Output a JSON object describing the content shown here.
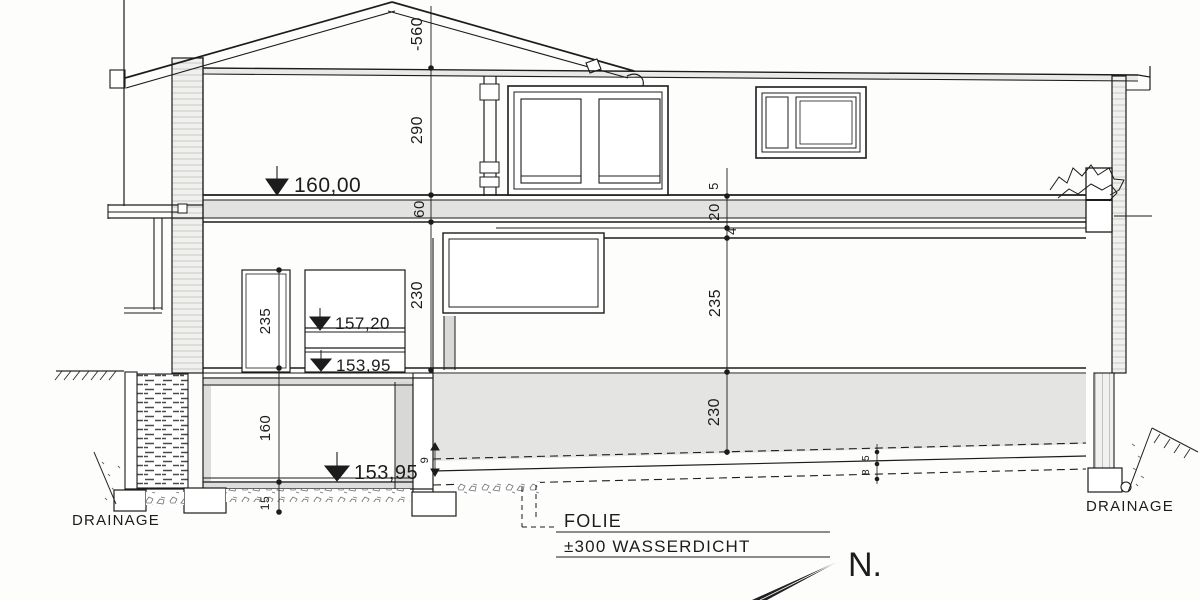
{
  "section": {
    "levels": {
      "eg": "160,00",
      "landing": "157,20",
      "split_lower": "153,95",
      "basement": "153,95"
    },
    "dimensions": {
      "ridge": "-560",
      "upper_room": "290",
      "floor_slab": "60",
      "left_mid_room": "230",
      "door_opening": "235",
      "right_upper_room": "235",
      "right_lower_room": "230",
      "layer_top": "5",
      "layer_mid": "20",
      "layer_bottom": "4",
      "basement_room": "160",
      "basement_slab": "15",
      "slope_left": "9",
      "slope_right_top": "5",
      "slope_right_bottom": "8"
    },
    "notes": {
      "drainage_left": "DRAINAGE",
      "drainage_right": "DRAINAGE",
      "folie_title": "FOLIE",
      "folie_spec": "±300 WASSERDICHT"
    },
    "compass": {
      "north": "N."
    },
    "colors": {
      "line": "#1c1c1c",
      "slab_gray": "#e2e2e1",
      "paper": "#fdfdfc"
    }
  }
}
